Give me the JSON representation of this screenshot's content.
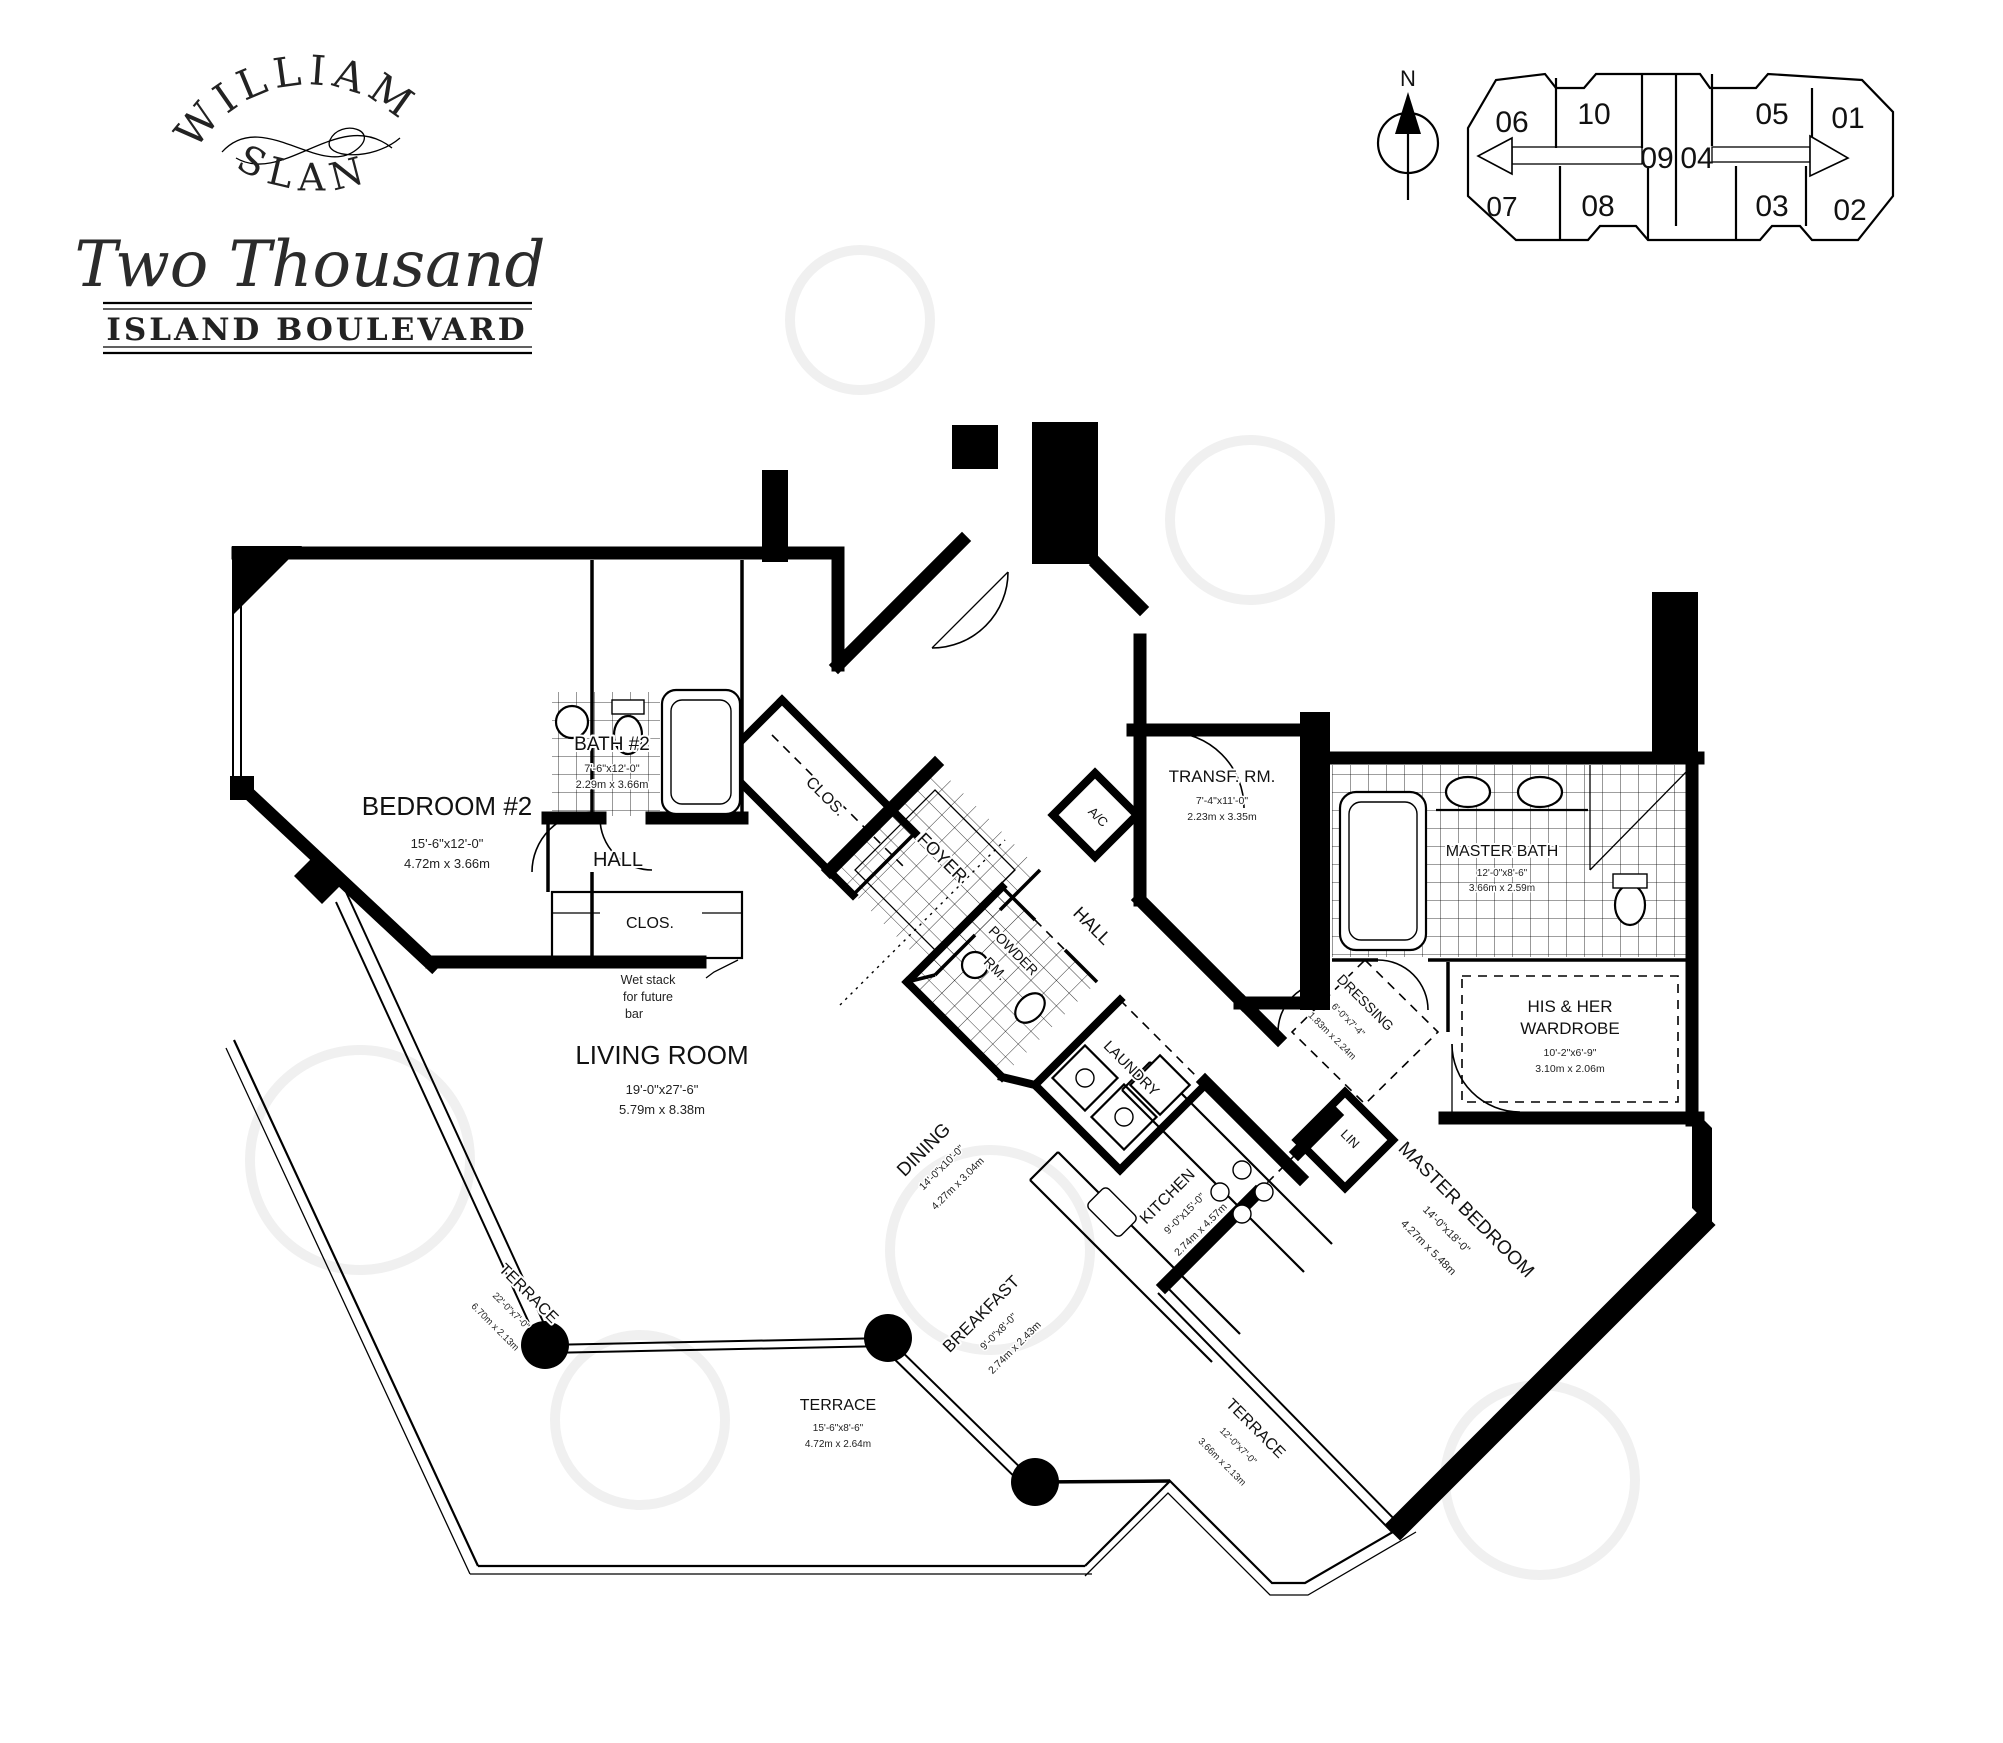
{
  "branding": {
    "arc_top": "WILLIAMS",
    "arc_bottom": "ISLAND",
    "line2": "Two Thousand",
    "banner": "ISLAND BOULEVARD"
  },
  "compass": {
    "north": "N"
  },
  "key_plan": {
    "units": {
      "u06": "06",
      "u10": "10",
      "u09": "09",
      "u04": "04",
      "u05": "05",
      "u01": "01",
      "u08": "08",
      "u03": "03",
      "u02": "02",
      "u07": "07"
    }
  },
  "rooms": {
    "bedroom2": {
      "name": "BEDROOM #2",
      "imperial": "15'-6\"x12'-0\"",
      "metric": "4.72m x 3.66m"
    },
    "bath2": {
      "name": "BATH #2",
      "imperial": "7'-6\"x12'-0\"",
      "metric": "2.29m x 3.66m"
    },
    "hall_west": {
      "name": "HALL"
    },
    "clos_west": {
      "name": "CLOS."
    },
    "clos_diag": {
      "name": "CLOS."
    },
    "foyer": {
      "name": "FOYER"
    },
    "powder": {
      "name_line1": "POWDER",
      "name_line2": "RM."
    },
    "laundry": {
      "name": "LAUNDRY"
    },
    "ac": {
      "name": "A/C"
    },
    "hall_center": {
      "name": "HALL"
    },
    "transfer": {
      "name": "TRANSF. RM.",
      "imperial": "7'-4\"x11'-0\"",
      "metric": "2.23m x 3.35m"
    },
    "master_bath": {
      "name": "MASTER BATH",
      "imperial": "12'-0\"x8'-6\"",
      "metric": "3.66m x 2.59m"
    },
    "wardrobe": {
      "name_line1": "HIS & HER",
      "name_line2": "WARDROBE",
      "imperial": "10'-2\"x6'-9\"",
      "metric": "3.10m x 2.06m"
    },
    "dressing": {
      "name": "DRESSING",
      "imperial": "6'-0\"x7'-4\"",
      "metric": "1.83m x 2.24m"
    },
    "lin": {
      "name": "LIN"
    },
    "living": {
      "name": "LIVING ROOM",
      "imperial": "19'-0\"x27'-6\"",
      "metric": "5.79m x 8.38m"
    },
    "dining": {
      "name": "DINING",
      "imperial": "14'-0\"x10'-0\"",
      "metric": "4.27m x 3.04m"
    },
    "breakfast": {
      "name": "BREAKFAST",
      "imperial": "9'-0\"x8'-0\"",
      "metric": "2.74m x 2.43m"
    },
    "kitchen": {
      "name": "KITCHEN",
      "imperial": "9'-0\"x15'-0\"",
      "metric": "2.74m x 4.57m"
    },
    "master_bedroom": {
      "name": "MASTER BEDROOM",
      "imperial": "14'-0\"x18'-0\"",
      "metric": "4.27m x 5.48m"
    },
    "terrace_left": {
      "name": "TERRACE",
      "imperial": "22'-0\"x7'-0\"",
      "metric": "6.70m x 2.13m"
    },
    "terrace_bottom": {
      "name": "TERRACE",
      "imperial": "15'-6\"x8'-6\"",
      "metric": "4.72m x 2.64m"
    },
    "terrace_right": {
      "name": "TERRACE",
      "imperial": "12'-0\"x7'-0\"",
      "metric": "3.66m x 2.13m"
    }
  },
  "note": {
    "line1": "Wet stack",
    "line2": "for future",
    "line3": "bar"
  }
}
